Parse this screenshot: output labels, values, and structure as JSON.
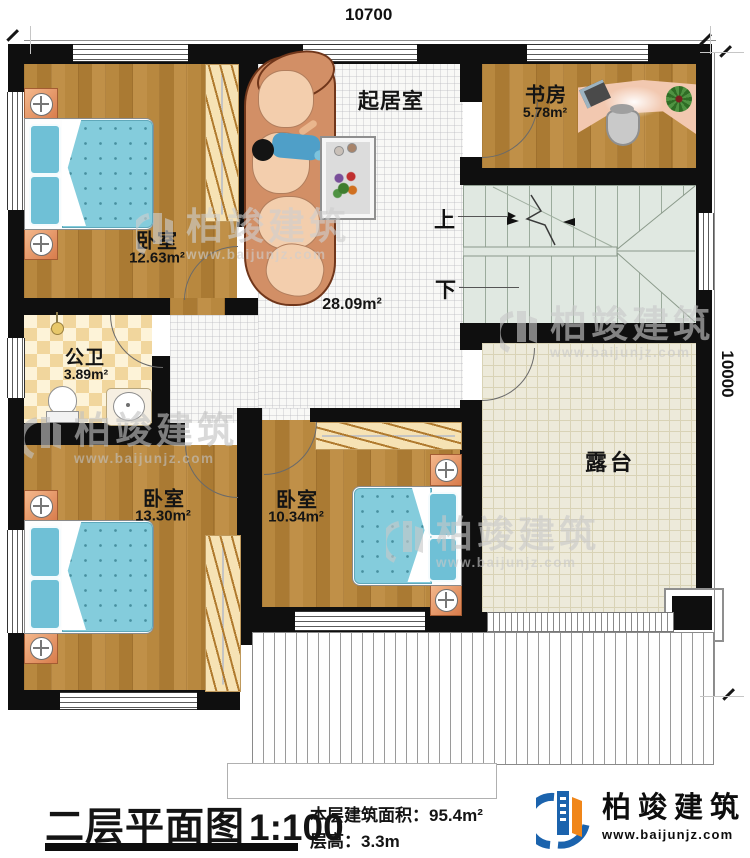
{
  "dimensions": {
    "top": "10700",
    "right": "10000"
  },
  "rooms": {
    "bedroom_tl": {
      "name": "卧室",
      "area": "12.63m²"
    },
    "living": {
      "name": "起居室",
      "area": "28.09m²"
    },
    "study": {
      "name": "书房",
      "area": "5.78m²"
    },
    "bathroom": {
      "name": "公卫",
      "area": "3.89m²"
    },
    "bedroom_bl": {
      "name": "卧室",
      "area": "13.30m²"
    },
    "bedroom_bm": {
      "name": "卧室",
      "area": "10.34m²"
    },
    "terrace": {
      "name": "露台"
    }
  },
  "stairs": {
    "up_label": "上",
    "down_label": "下"
  },
  "watermark": {
    "text": "柏竣建筑",
    "url": "www.baijunjz.com"
  },
  "title_block": {
    "title": "二层平面图",
    "scale": "1:100",
    "area_label": "本层建筑面积：",
    "area_value": "95.4m²",
    "height_label": "层高：",
    "height_value": "3.3m"
  },
  "logo": {
    "name": "柏竣建筑",
    "url": "www.baijunjz.com"
  },
  "colors": {
    "wall": "#0f0f0f",
    "wood": "#b2833c",
    "tile_light": "#fdf3d8",
    "tile_dark": "#f1d69d",
    "stair": "#e0e8e1",
    "terrace": "#edeada",
    "bed": "#84ccdc",
    "accent_blue": "#1b63ad",
    "accent_orange": "#f08619"
  }
}
